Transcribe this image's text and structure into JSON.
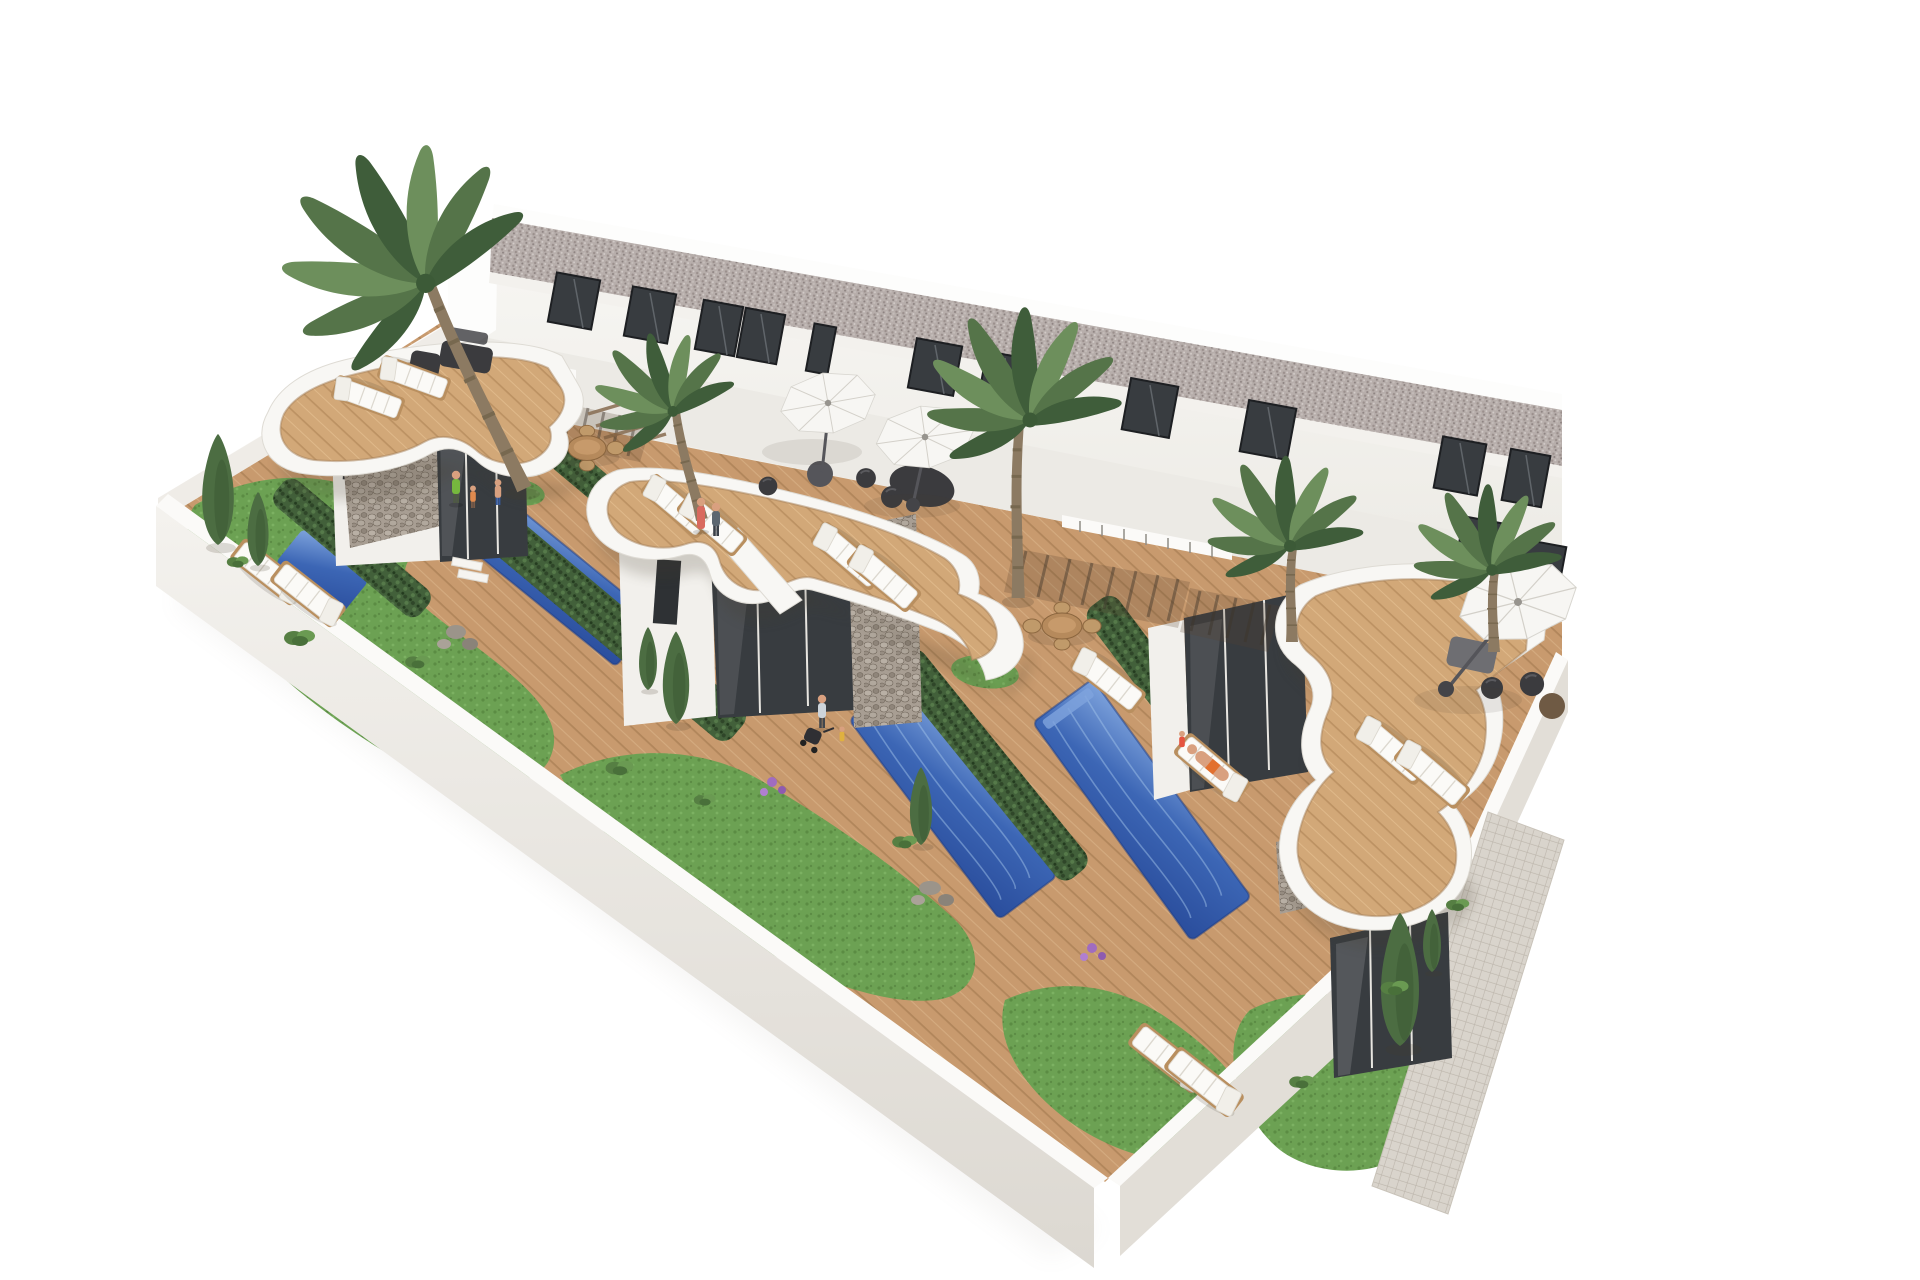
{
  "meta": {
    "title": "Aerial 3D architectural rendering of four modern white townhouses with private pools",
    "description": "Bird's-eye render of a row of two-storey white townhouses with a gravel flat roof, curved white roof terraces with wooden decks, white sun loungers, white parasols, dark lounge furniture, private blue swimming pools separated by hedges, wooden ground decks, green lawns, palm trees, cypresses, a white perimeter wall and a tiled walkway along the right edge."
  },
  "palette": {
    "bg": "#ffffff",
    "building": "#f5f4f1",
    "buildingShade": "#eceae5",
    "roofGravel": "#b7aeab",
    "windowGlass": "#383c40",
    "windowFrame": "#1f2124",
    "deckWood": "#c89a6e",
    "deckLine": "#a1784e",
    "terraceWood": "#d2a878",
    "poolLight": "#7fa4dd",
    "poolMid": "#3c66b5",
    "poolDeep": "#2a4d9c",
    "lawn": "#6ca153",
    "lawnDark": "#55833f",
    "hedge": "#42603a",
    "hedgeDark": "#2f4629",
    "stone": "#a89e93",
    "stoneDark": "#6e6459",
    "terraceWhite": "#f8f7f4",
    "wallTop": "#fbfaf8",
    "wallFace": "#efece7",
    "wallShade": "#e2ded7",
    "tile": "#d9d4cc",
    "tileLine": "#bcb5ab",
    "palmGreen": "#557449",
    "palmDark": "#3f5d3a",
    "palmLight": "#6d8f5c",
    "trunkBrown": "#8c7a62",
    "umbrellaWhite": "#f7f6f3",
    "furnitureDark": "#3b3b3e",
    "furnWood": "#b98f5f",
    "skin": "#d9a07f",
    "shadow": "#473c2f"
  },
  "scene": {
    "view": "aerial-isometric",
    "units": 4,
    "building": {
      "storeys": 2,
      "roof": "flat gravel",
      "facade": "white",
      "upper_windows": 11
    },
    "per_unit_features": [
      "curved white roof terrace with wood deck",
      "private pool",
      "wooden ground deck",
      "lawn",
      "separating hedge"
    ],
    "furniture": {
      "sun_loungers": 14,
      "parasols": 3,
      "dining_sets": 2,
      "dark_lounge_sets": 3,
      "poufs": 7,
      "stroller": 1
    },
    "vegetation": {
      "palm_trees": 5,
      "cypresses": 7,
      "bushes": 9,
      "flower_clusters": 2
    },
    "perimeter": {
      "wall": "white",
      "walkway": "beige tiled path along lower-right edge"
    },
    "people": 9
  }
}
